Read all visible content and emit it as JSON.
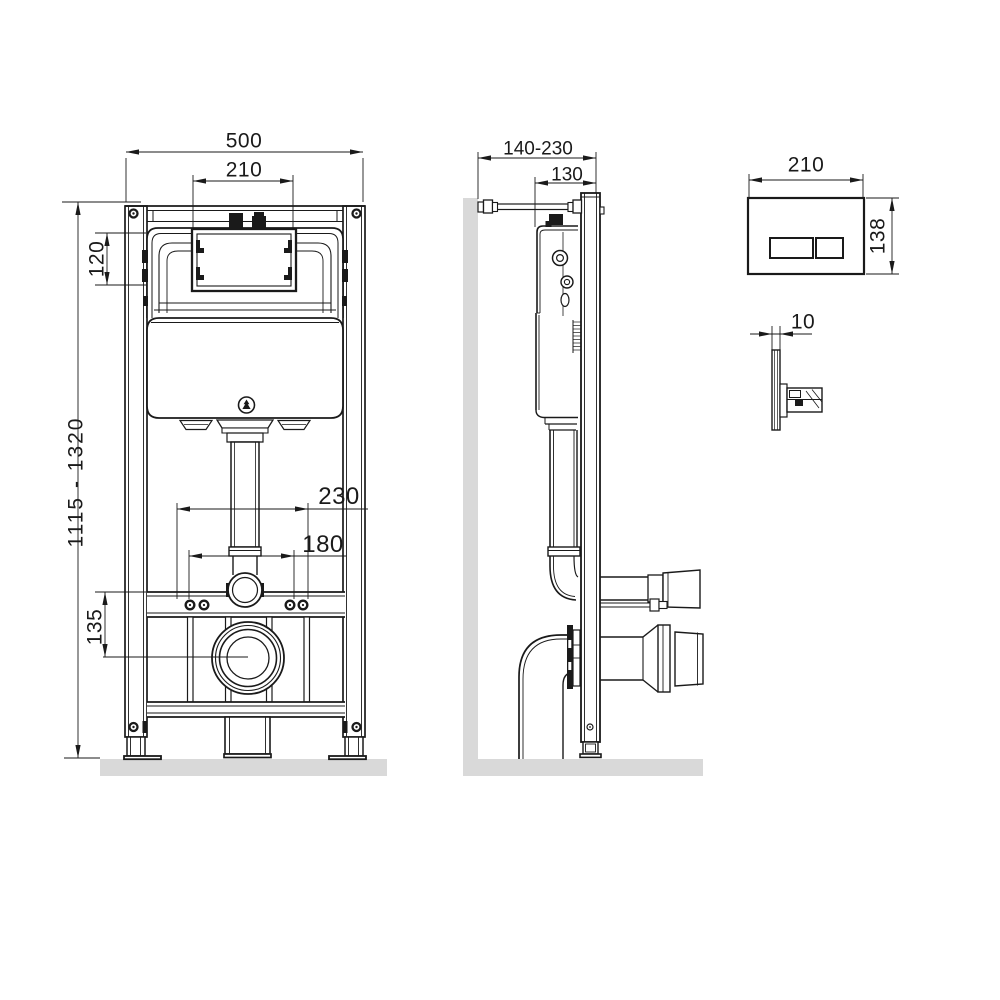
{
  "page": {
    "type": "technical installation drawing",
    "subject": "wall-hung WC concealed cistern installation frame with dual-flush plate",
    "background": "#ffffff"
  },
  "colors": {
    "line": "#1a1a1a",
    "surface_gray": "#d9d9d9"
  },
  "views": {
    "front": {
      "label": "frame front view",
      "dims": {
        "frame_width": "500",
        "window_width": "210",
        "window_height": "120",
        "height_range": "1115 - 1320",
        "outlet_center_height": "135",
        "fixing_spacing_outer": "230",
        "fixing_spacing_inner": "180"
      }
    },
    "side": {
      "label": "frame side view",
      "dims": {
        "wall_distance_range": "140-230",
        "frame_depth": "130"
      }
    },
    "plate_front": {
      "label": "flush plate front view",
      "dims": {
        "width": "210",
        "height": "138"
      }
    },
    "plate_side": {
      "label": "flush plate side view",
      "dims": {
        "thickness": "10"
      }
    }
  }
}
